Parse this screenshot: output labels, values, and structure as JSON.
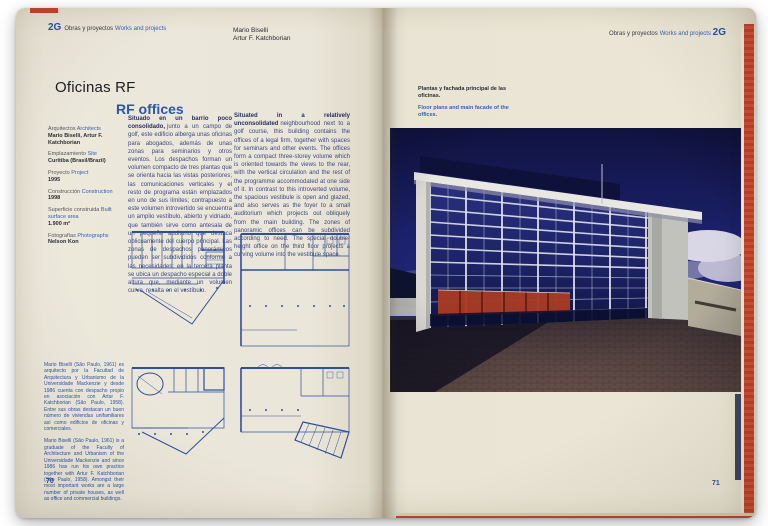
{
  "meta": {
    "description": "Open spread of 2G architecture journal, pages 70-71"
  },
  "colors": {
    "paper": "#eae6d9",
    "accent_blue": "#2b56aa",
    "plan_blue": "#2e4f9a",
    "edge_red": "#cd4e35",
    "photo_sky": "#1b2070",
    "photo_panel_red": "#a83a24"
  },
  "left_page": {
    "header": {
      "logo": "2G",
      "label_es": "Obras y proyectos",
      "label_en": "Works and projects"
    },
    "authors": [
      "Mario Biselli",
      "Artur F. Katchborian"
    ],
    "title_es": "Oficinas RF",
    "title_en": "RF offices",
    "project_info": [
      {
        "label_es": "Arquitectos",
        "label_en": "Architects",
        "value": "Mario Biselli, Artur F. Katchborian"
      },
      {
        "label_es": "Emplazamiento",
        "label_en": "Site",
        "value": "Curitiba (Brasil/Brazil)"
      },
      {
        "label_es": "Proyecto",
        "label_en": "Project",
        "value": "1995"
      },
      {
        "label_es": "Construcción",
        "label_en": "Construction",
        "value": "1998"
      },
      {
        "label_es": "Superficie construida",
        "label_en": "Built surface area",
        "value": "1.900 m²"
      },
      {
        "label_es": "Fotografías",
        "label_en": "Photographs",
        "value": "Nelson Kon"
      }
    ],
    "body_es": {
      "lead": "Situado en un barrio poco consolidado,",
      "text": "junto a un campo de golf, este edificio alberga unas oficinas para abogados, además de unas zonas para seminarios y otros eventos. Los despachos forman un volumen compacto de tres plantas que se orienta hacia las vistas posteriores; las comunicaciones verticales y el resto de programa están emplazados en uno de sus límites; contrapuesto a este volumen introvertido se encuentra un amplio vestíbulo, abierto y vidriado, que también sirve como antesala de un pequeño auditorio que destaca oblicuamente del cuerpo principal. Las zonas de despachos panorámicos pueden ser subdivididos conforme a las necesidades; en la tercera planta se ubica un despacho especial a doble altura que, mediante un volumen curvo, resalta en el vestíbulo."
    },
    "body_en": {
      "lead": "Situated in a relatively unconsolidated",
      "text": "neighbourhood next to a golf course, this building contains the offices of a legal firm, together with spaces for seminars and other events. The offices form a compact three-storey volume which is oriented towards the views to the rear, with the vertical circulation and the rest of the programme accommodated at one side of it. In contrast to this introverted volume, the spacious vestibule is open and glazed, and also serves as the foyer to a small auditorium which projects out obliquely from the main building. The zones of panoramic offices can be subdivided according to need. The special double-height office on the third floor projects a curving volume into the vestibule space."
    },
    "bio_es": "Mario Biselli (São Paulo, 1961) es arquitecto por la Facultad de Arquitectura y Urbanismo de la Universidade Mackenzie y desde 1986 cuenta con despacho propio en asociación con Artur F. Katchborian (São Paulo, 1958). Entre sus obras destacan un buen número de viviendas unifamiliares así como edificios de oficinas y comerciales.",
    "bio_en": "Mario Biselli (São Paulo, 1961) is a graduate of the Faculty of Architecture and Urbanism of the Universidade Mackenzie and since 1986 has run his own practice together with Artur F. Katchborian (São Paulo, 1958). Amongst their most important works are a large number of private houses, as well as office and commercial buildings.",
    "page_number": "70"
  },
  "right_page": {
    "header": {
      "label_es": "Obras y proyectos",
      "label_en": "Works and projects",
      "logo": "2G"
    },
    "caption_es": "Plantas y fachada principal de las oficinas.",
    "caption_en": "Floor plans and main facade of the offices.",
    "page_number": "71"
  }
}
